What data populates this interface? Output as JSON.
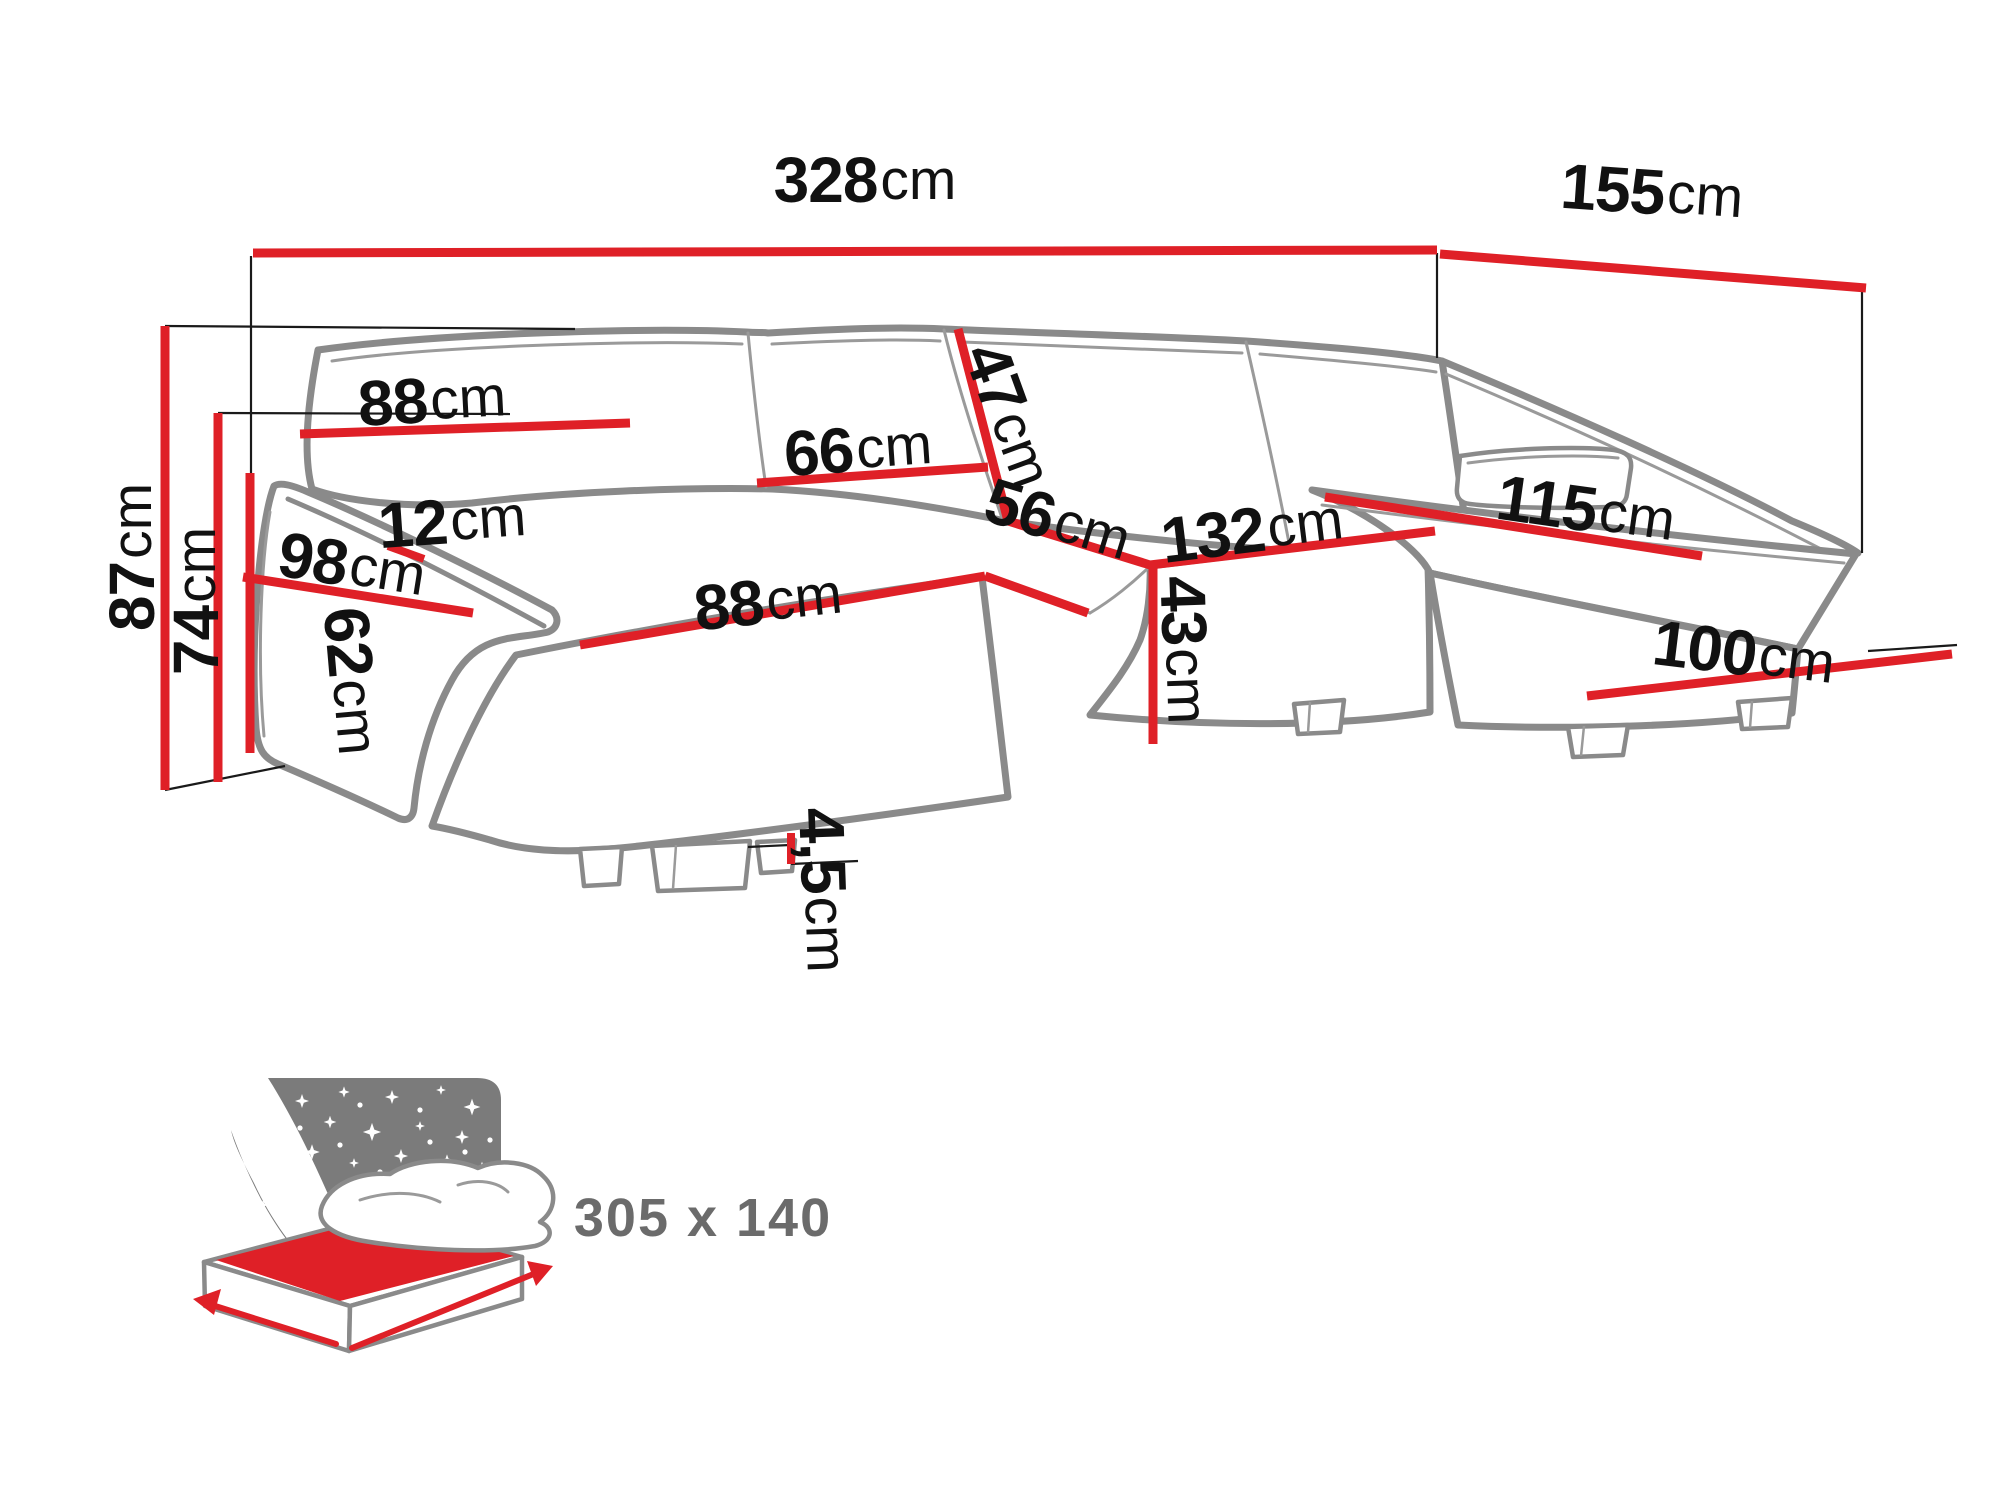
{
  "diagram": {
    "type": "sofa-dimension-diagram",
    "unit": "cm",
    "colors": {
      "dimension_red": "#df2027",
      "outline_gray": "#8a8a8a",
      "label_black": "#111111",
      "sleeping_gray": "#6b6b6b",
      "panel_gray": "#7b7b7b"
    },
    "dimensions": [
      {
        "id": "overall-width",
        "value": "328",
        "unit": "cm"
      },
      {
        "id": "right-side-depth",
        "value": "155",
        "unit": "cm"
      },
      {
        "id": "total-height",
        "value": "87",
        "unit": "cm"
      },
      {
        "id": "backrest-height",
        "value": "74",
        "unit": "cm"
      },
      {
        "id": "back-cushion-left",
        "value": "88",
        "unit": "cm"
      },
      {
        "id": "back-cushion-middle",
        "value": "66",
        "unit": "cm"
      },
      {
        "id": "back-cushion-height",
        "value": "47",
        "unit": "cm"
      },
      {
        "id": "seat-depth",
        "value": "56",
        "unit": "cm"
      },
      {
        "id": "middle-seat-width",
        "value": "132",
        "unit": "cm"
      },
      {
        "id": "seat-height",
        "value": "43",
        "unit": "cm"
      },
      {
        "id": "left-seat-front",
        "value": "88",
        "unit": "cm"
      },
      {
        "id": "armrest-width",
        "value": "12",
        "unit": "cm"
      },
      {
        "id": "left-chaise-depth",
        "value": "98",
        "unit": "cm"
      },
      {
        "id": "armrest-height",
        "value": "62",
        "unit": "cm"
      },
      {
        "id": "right-chaise-top",
        "value": "115",
        "unit": "cm"
      },
      {
        "id": "right-chaise-front",
        "value": "100",
        "unit": "cm"
      },
      {
        "id": "leg-height",
        "value": "4,5",
        "unit": "cm"
      }
    ],
    "sleeping_area": {
      "value": "305 x 140"
    }
  }
}
